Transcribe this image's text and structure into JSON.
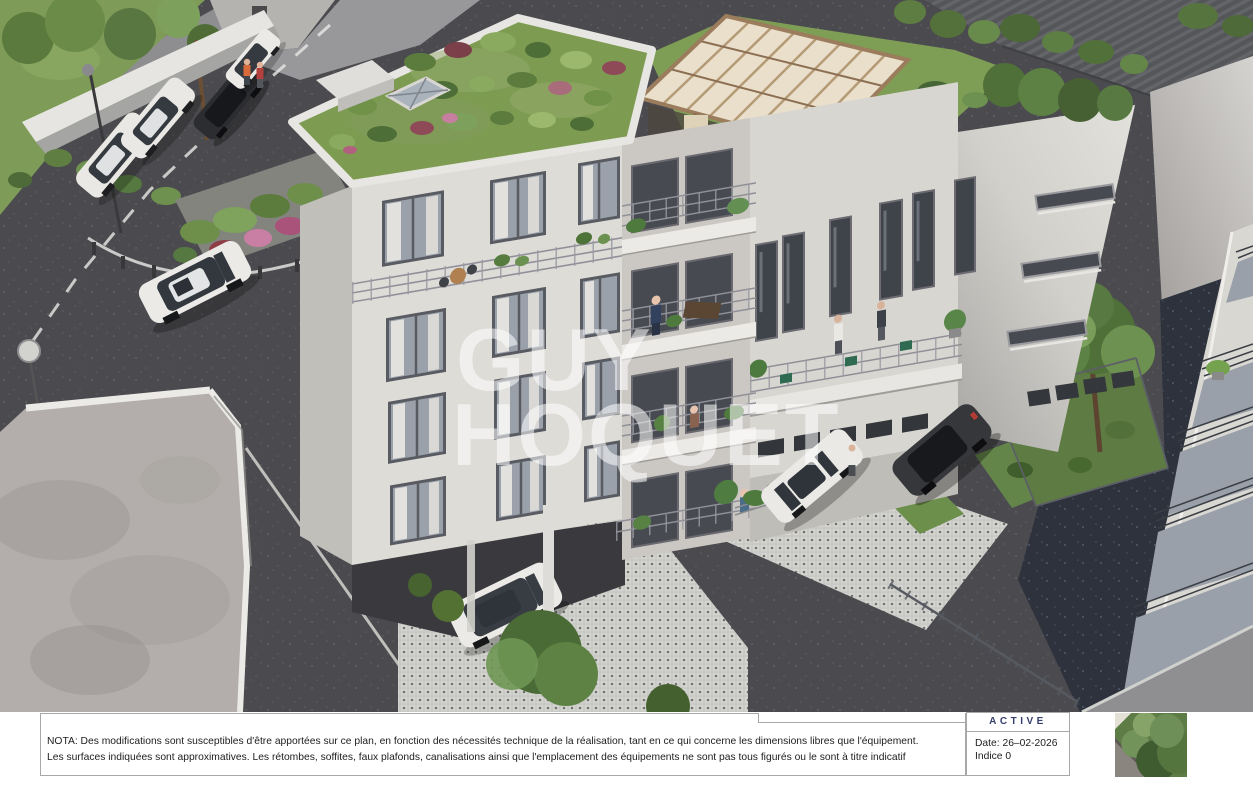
{
  "watermark": {
    "line1": "GUY",
    "line2": "HOQUET"
  },
  "title_block": {
    "nota_line1": "NOTA: Des modifications sont susceptibles d'être apportées sur ce plan, en fonction des nécessités technique de la réalisation, tant en ce qui concerne les dimensions libres que l'équipement.",
    "nota_line2": "Les surfaces indiquées sont approximatives. Les rétombes, soffites, faux plafonds, canalisations ainsi que l'emplacement des équipements ne sont pas tous figurés ou le sont à titre indicatif",
    "status_label": "ACTIVE",
    "date_label": "Date: 26–02-2026",
    "indice_label": "Indice 0"
  },
  "colors": {
    "status_text": "#35406e",
    "titleblock_border": "#a8a8a8",
    "body_text": "#1d1d1d",
    "watermark": "#ffffff"
  }
}
